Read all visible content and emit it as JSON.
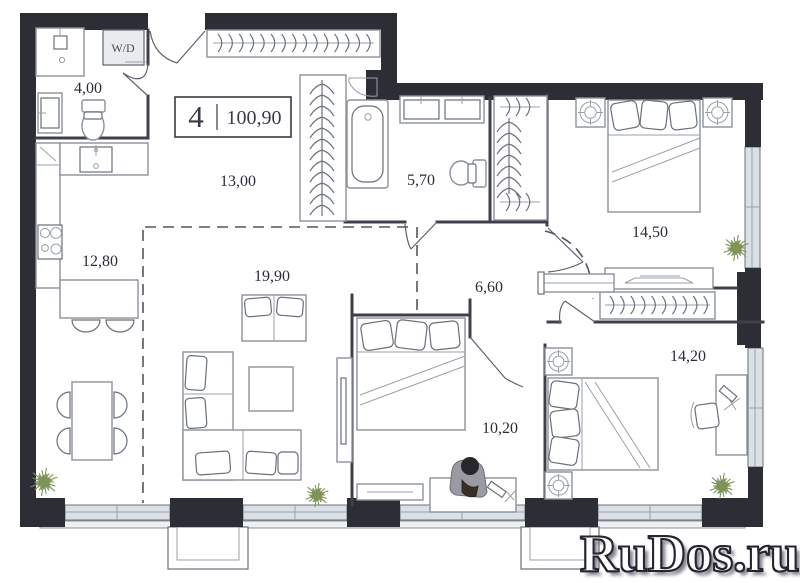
{
  "title": {
    "rooms_count": "4",
    "total_area": "100,90"
  },
  "wd_label": "W/D",
  "rooms": [
    {
      "id": "bathroom-small",
      "area": "4,00"
    },
    {
      "id": "hallway-main",
      "area": "13,00"
    },
    {
      "id": "kitchen",
      "area": "12,80"
    },
    {
      "id": "living-room",
      "area": "19,90"
    },
    {
      "id": "bathroom-main",
      "area": "5,70"
    },
    {
      "id": "hallway-inner",
      "area": "6,60"
    },
    {
      "id": "bedroom-top",
      "area": "14,50"
    },
    {
      "id": "bedroom-right",
      "area": "14,20"
    },
    {
      "id": "bedroom-middle",
      "area": "10,20"
    }
  ],
  "watermark": {
    "text": "RuDos.ru",
    "fill": "#ffffff",
    "outline": "#25252f"
  },
  "colors": {
    "wall": "#2d2d35",
    "interior_wall": "#40404c",
    "furniture_line": "#8b929b",
    "window_fill": "#dbe0e6",
    "plant": "#7f9357",
    "label_text": "#2c2c38"
  }
}
